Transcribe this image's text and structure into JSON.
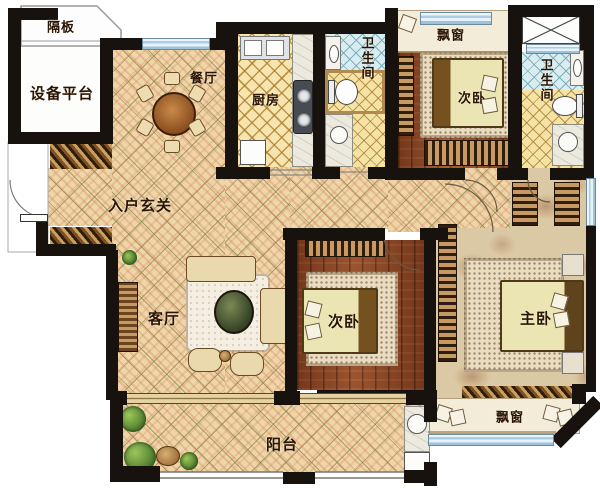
{
  "plan": {
    "type": "apartment-floor-plan",
    "rooms": {
      "partition": "隔板",
      "equipment": "设备平台",
      "dining": "餐厅",
      "kitchen": "厨房",
      "bath_top": "卫生间",
      "bay_window_top": "飘窗",
      "bedroom_second_top": "次卧",
      "bath_right": "卫生间",
      "foyer": "入户玄关",
      "living": "客厅",
      "bedroom_second_mid": "次卧",
      "master_bedroom": "主卧",
      "balcony": "阳台",
      "bay_window_bottom": "飘窗"
    },
    "colors": {
      "wall": "#17120d",
      "floor_tile": "#eed6a8",
      "kitchen_floor": "#f6e5ae",
      "bath_floor_blue": "#d9edf1",
      "bath_floor_yellow": "#f4e3a4",
      "bedroom_wood": "#8a4423",
      "master_floor": "#dbc8a4",
      "window_glass": "#a9cde3",
      "bay_sill": "#f3ecd8",
      "label_text": "#2a1505"
    }
  }
}
